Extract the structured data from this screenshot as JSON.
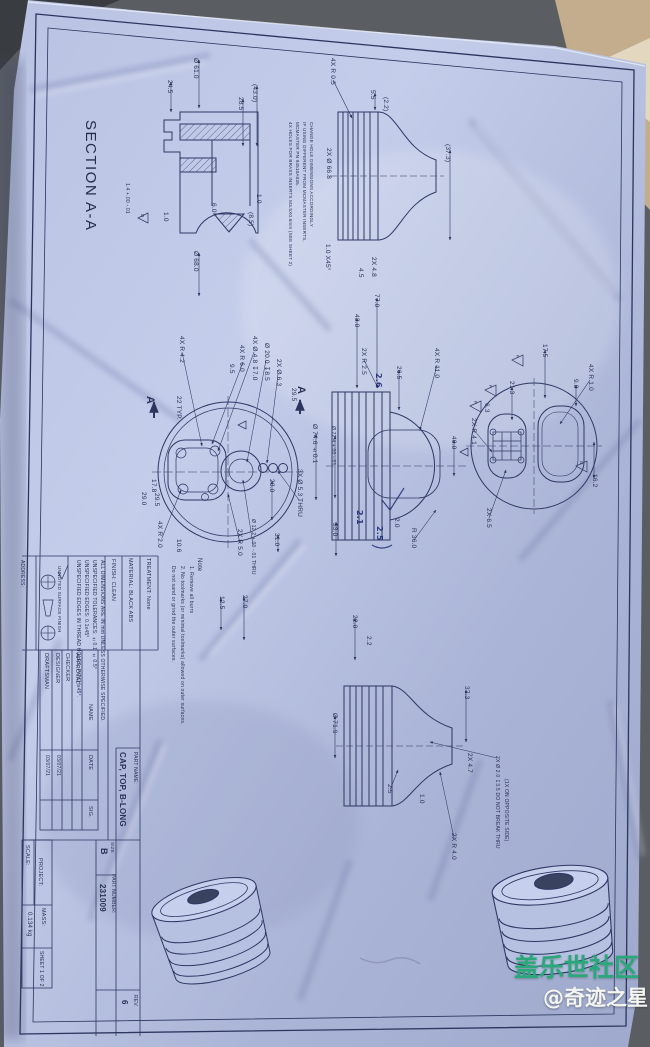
{
  "watermark": {
    "line1": "盖乐世社区",
    "line2": "@奇迹之星"
  },
  "drawing": {
    "section_label": "SECTION A-A",
    "insert_note": [
      "4X HOLES FOR BRASS INSERTS M3.5X0.6mm (SEE SHEET 2)",
      "MCMASTER PN 94510A035.",
      "IF USING DIFFERENT FROM MCMASTER INSERTS,",
      "CHANGE HOLE DIMENSIONS ACCORDINGLY"
    ],
    "notes": [
      "Note",
      "1. Remove all burrs",
      "2. No toolmarks (or minimal toolmarks) allowed on outer surfaces.",
      "Do not sand or grind the outer surfaces."
    ],
    "general_notes": [
      "ALL DIMENSIONS ARE IN mm UNLESS OTHERWISE SPECIFIED.",
      "UNSPECIFIED TOLERANCES: ±0.1  ±0.5°",
      "UNSPECIFIED EDGES: 0.1x45°",
      "UNSPECIFIED EDGES IN THREAD HOLES: PITCHx45°.",
      "UNNOTED SURFACE FINISH"
    ],
    "views": {
      "section_aa": {
        "dims": [
          "Ø 61.0",
          "24.5",
          "(43.0)",
          "28.5",
          "1.0",
          "6.0",
          "(8.5)",
          "1.0",
          "1.4 +.00 -.01",
          "Ø 68.0"
        ],
        "datum": "D"
      },
      "profile_top": {
        "dims": [
          "4X R 0.5",
          "5.5",
          "(2.2)",
          "(37.3)",
          "2X Ø 66.8",
          "1.0 X45°",
          "2X 4.8",
          "4.5"
        ]
      },
      "top_view": {
        "section_marker": "A",
        "dims": [
          "4X R 4.2",
          "4X R 6.0",
          "4X Ø 4.8 ↧7.0",
          "Ø 20.0 ↧8.5",
          "2X Ø 6.3",
          "9.5",
          "29.5",
          "22 TYP.",
          "23.0",
          "3X Ø 5.3 THRU",
          "31.0",
          "Ø 12.2 +.00 -.01 THRU",
          "2X R 5.0",
          "10.6",
          "4X R 2.0",
          "29.5",
          "17.8",
          "29.0"
        ]
      },
      "center_section": {
        "dims": [
          "77.0",
          "43.0",
          "26.5",
          "2X R 2.5",
          "4X R 11.0",
          "40.0",
          "Ø 74.6 ±0.1",
          "Ø 72.4 +.00 -.01",
          "33.0",
          "2.0",
          "R 36.0"
        ],
        "handwritten": [
          "2.6",
          "2.1",
          "2.5"
        ]
      },
      "bottom_view": {
        "dims": [
          "17.5",
          "9.0",
          "4X R 1.0",
          "21.3",
          "6.3",
          "2X R 4.1",
          "16.2",
          "2X 6.5"
        ],
        "flags": [
          "F",
          "F",
          "F",
          "G"
        ]
      },
      "profile_bottom": {
        "dims": [
          "22.0",
          "2.2",
          "37.3",
          "2X 4.7",
          "Ø 71.9",
          "2.5",
          "1.0",
          "2X R 4.0",
          "2X Ø 2.0 ↧3.5 DO NOT BREAK THRU",
          "(1X ON OPPOSITE SIDE)",
          "12.5",
          "27.0"
        ]
      }
    },
    "title_block": {
      "address_label": "ADDRESS:",
      "finish": "FINISH: CLEAN",
      "material": "MATERIAL: BLACK ABS",
      "treatment": "TREATMENT: None",
      "roles": [
        "DRAFTSMAN",
        "DESIGNER",
        "CHECKER",
        "APPROVAL"
      ],
      "name_header": "NAME",
      "date_header": "DATE",
      "sig_header": "SIG.",
      "dates": [
        "03/07/21",
        "03/07/21"
      ],
      "part_name_label": "PART NAME:",
      "part_name": "CAP, TOP, B-LONG",
      "size_label": "SIZE",
      "size": "B",
      "part_number_label": "PART NUMBER:",
      "part_number": "231009",
      "rev_label": "REV.",
      "rev": "6",
      "scale_label": "SCALE:",
      "project_label": "PROJECT:",
      "mass_label": "MASS:",
      "mass": "0.134 kg",
      "sheet": "SHEET 1 OF 2"
    }
  }
}
